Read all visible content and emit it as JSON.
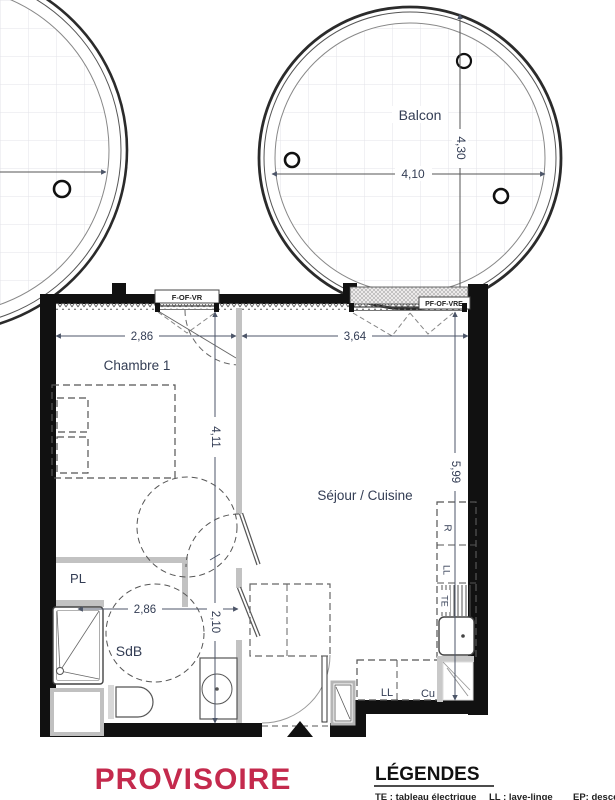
{
  "colors": {
    "stamp": "#c42a4d",
    "wall": "#111111",
    "dim_text": "#333d54"
  },
  "balcony": {
    "label": "Balcon",
    "width_dim": "4,10",
    "height_dim": "4,30"
  },
  "windows": {
    "chambre_window": "F-OF-VR",
    "sejour_window": "PF-OF-VRE"
  },
  "rooms": {
    "chambre": "Chambre 1",
    "sejour": "Séjour / Cuisine",
    "bathroom": "SdB",
    "closet": "PL"
  },
  "dims": {
    "chambre_width": "2,86",
    "sejour_width": "3,64",
    "chambre_depth": "4,11",
    "sejour_depth": "5,99",
    "bathroom_width": "2,86",
    "bathroom_depth": "2,10"
  },
  "kitchen": {
    "fridge": "R",
    "washer_column": "LL",
    "electrical_panel": "TE",
    "washer": "LL",
    "cooker": "Cu"
  },
  "footer": {
    "stamp": "PROVISOIRE"
  },
  "legend": {
    "title": "LÉGENDES",
    "item_te": "TE : tableau électrique",
    "item_ll": "LL : lave-linge",
    "item_ep": "EP: desce"
  }
}
